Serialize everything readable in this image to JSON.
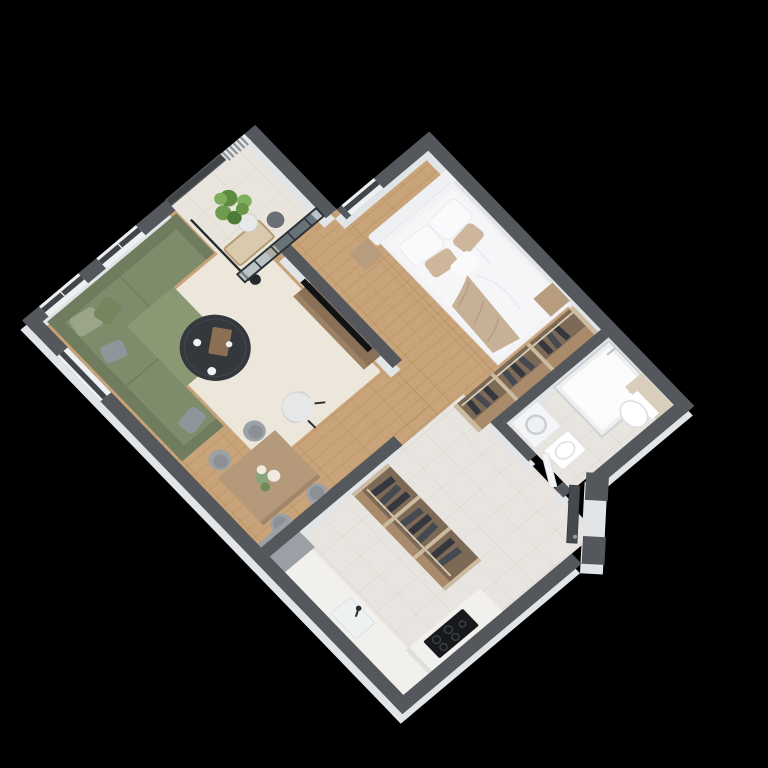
{
  "meta": {
    "type": "3d-floor-plan-render",
    "view": "isometric-top-down",
    "background": "#000000"
  },
  "colors": {
    "bg": "#000000",
    "wallTop": "#54585d",
    "wallFace": "#e2e5e8",
    "sill": "#eef0f2",
    "windowGlass": "#41464c",
    "frameDark": "#2e3236",
    "glazedGlass": "#9fb0ba",
    "railing": "#747b82",
    "louver": "#8f9499",
    "louverBase": "#e8e9ea",
    "wood": "#c9a37a",
    "woodLine": "#b8905f",
    "tile": "#e8e4df",
    "tileLine": "#d9d3cb",
    "balconyTile": "#eae5dc",
    "balconyTileLine": "#dcd5c9",
    "rug": "#ece7da",
    "sofa": "#7e8c6b",
    "sofaBack": "#6f7d5e",
    "sofaChaise": "#8a9873",
    "pillowGreen": "#9aa58a",
    "pillowOlive": "#77855f",
    "pillowGray": "#8f959b",
    "coffeeTable": "#34383c",
    "tray": "#8a6f52",
    "cupWhite": "#f2f2f2",
    "armchair": "#e6e7e9",
    "armchairBack": "#d3d5d8",
    "legDark": "#2a2d2f",
    "diningTable": "#b4997a",
    "chairGray": "#9ba1a6",
    "chairSeat": "#8a9094",
    "flowersGreen": "#8ba37a",
    "flowersWhite": "#efe9df",
    "tv": "#101214",
    "console": "#8a7057",
    "consoleTop": "#9c8163",
    "bedFrame": "#f3f3f5",
    "headboard": "#eef0f2",
    "duvet": "#f6f6f8",
    "duvetShade": "#e9eaef",
    "throw": "#c7b196",
    "pillowWhite": "#fafafc",
    "pillowBeige": "#cdb69c",
    "nightstand": "#b79c7d",
    "closetWood": "#a98a6a",
    "closetInner": "#7c6a57",
    "closetShelf": "#cdbb9f",
    "clothesDark": "#34383e",
    "clothesAlt": "#454a52",
    "rail": "#d8c8ae",
    "shower": "#fafafa",
    "showerGlassStroke": "#ccd3d8",
    "fixtureWhite": "#ffffff",
    "fixtureStroke": "#dde0e4",
    "accentWall": "#d9cdbb",
    "washer": "#f4f5f6",
    "washerDrum": "#c9ced3",
    "counter": "#f1f0ed",
    "counterEdge": "#e0ded9",
    "sinkSteel": "#eef1f2",
    "cooktop": "#17191c",
    "burner": "#3c4146",
    "grayUnit": "#9aa0a5",
    "door": "#464a50",
    "doorWhite": "#f2f3f5",
    "plant1": "#6f9b4f",
    "plant2": "#5d8b41",
    "plant3": "#7fae5e",
    "plant4": "#4e7a38",
    "pot": "#e8e8ea",
    "floorLamp": "#26292c",
    "benchCushion": "#d9c9ad",
    "benchWood": "#b59a74"
  },
  "scene": {
    "rooms": [
      {
        "id": "living-room",
        "floor": "wood",
        "furniture": [
          "sectional-sofa",
          "throw-pillows",
          "area-rug",
          "coffee-table",
          "armchair",
          "floor-lamp",
          "tv-wall",
          "media-console",
          "dining-table",
          "dining-chairs",
          "flower-centerpiece"
        ]
      },
      {
        "id": "balcony",
        "floor": "tile",
        "furniture": [
          "glass-railing",
          "louver-screen",
          "potted-plant",
          "bench",
          "side-table"
        ]
      },
      {
        "id": "bedroom",
        "floor": "wood",
        "furniture": [
          "double-bed",
          "headboard",
          "nightstand",
          "ottoman-cube",
          "open-closet-with-clothes"
        ]
      },
      {
        "id": "bathroom",
        "floor": "tile",
        "furniture": [
          "walk-in-shower",
          "wall-hung-toilet",
          "accent-panel",
          "washing-machine",
          "washbasin",
          "bathroom-door"
        ]
      },
      {
        "id": "hallway",
        "floor": "tile",
        "furniture": [
          "open-wardrobe-with-clothes",
          "entrance-door"
        ]
      },
      {
        "id": "kitchen",
        "floor": "tile",
        "furniture": [
          "kitchen-counter",
          "kitchen-sink",
          "cooktop",
          "tall-gray-cabinet"
        ]
      }
    ]
  }
}
